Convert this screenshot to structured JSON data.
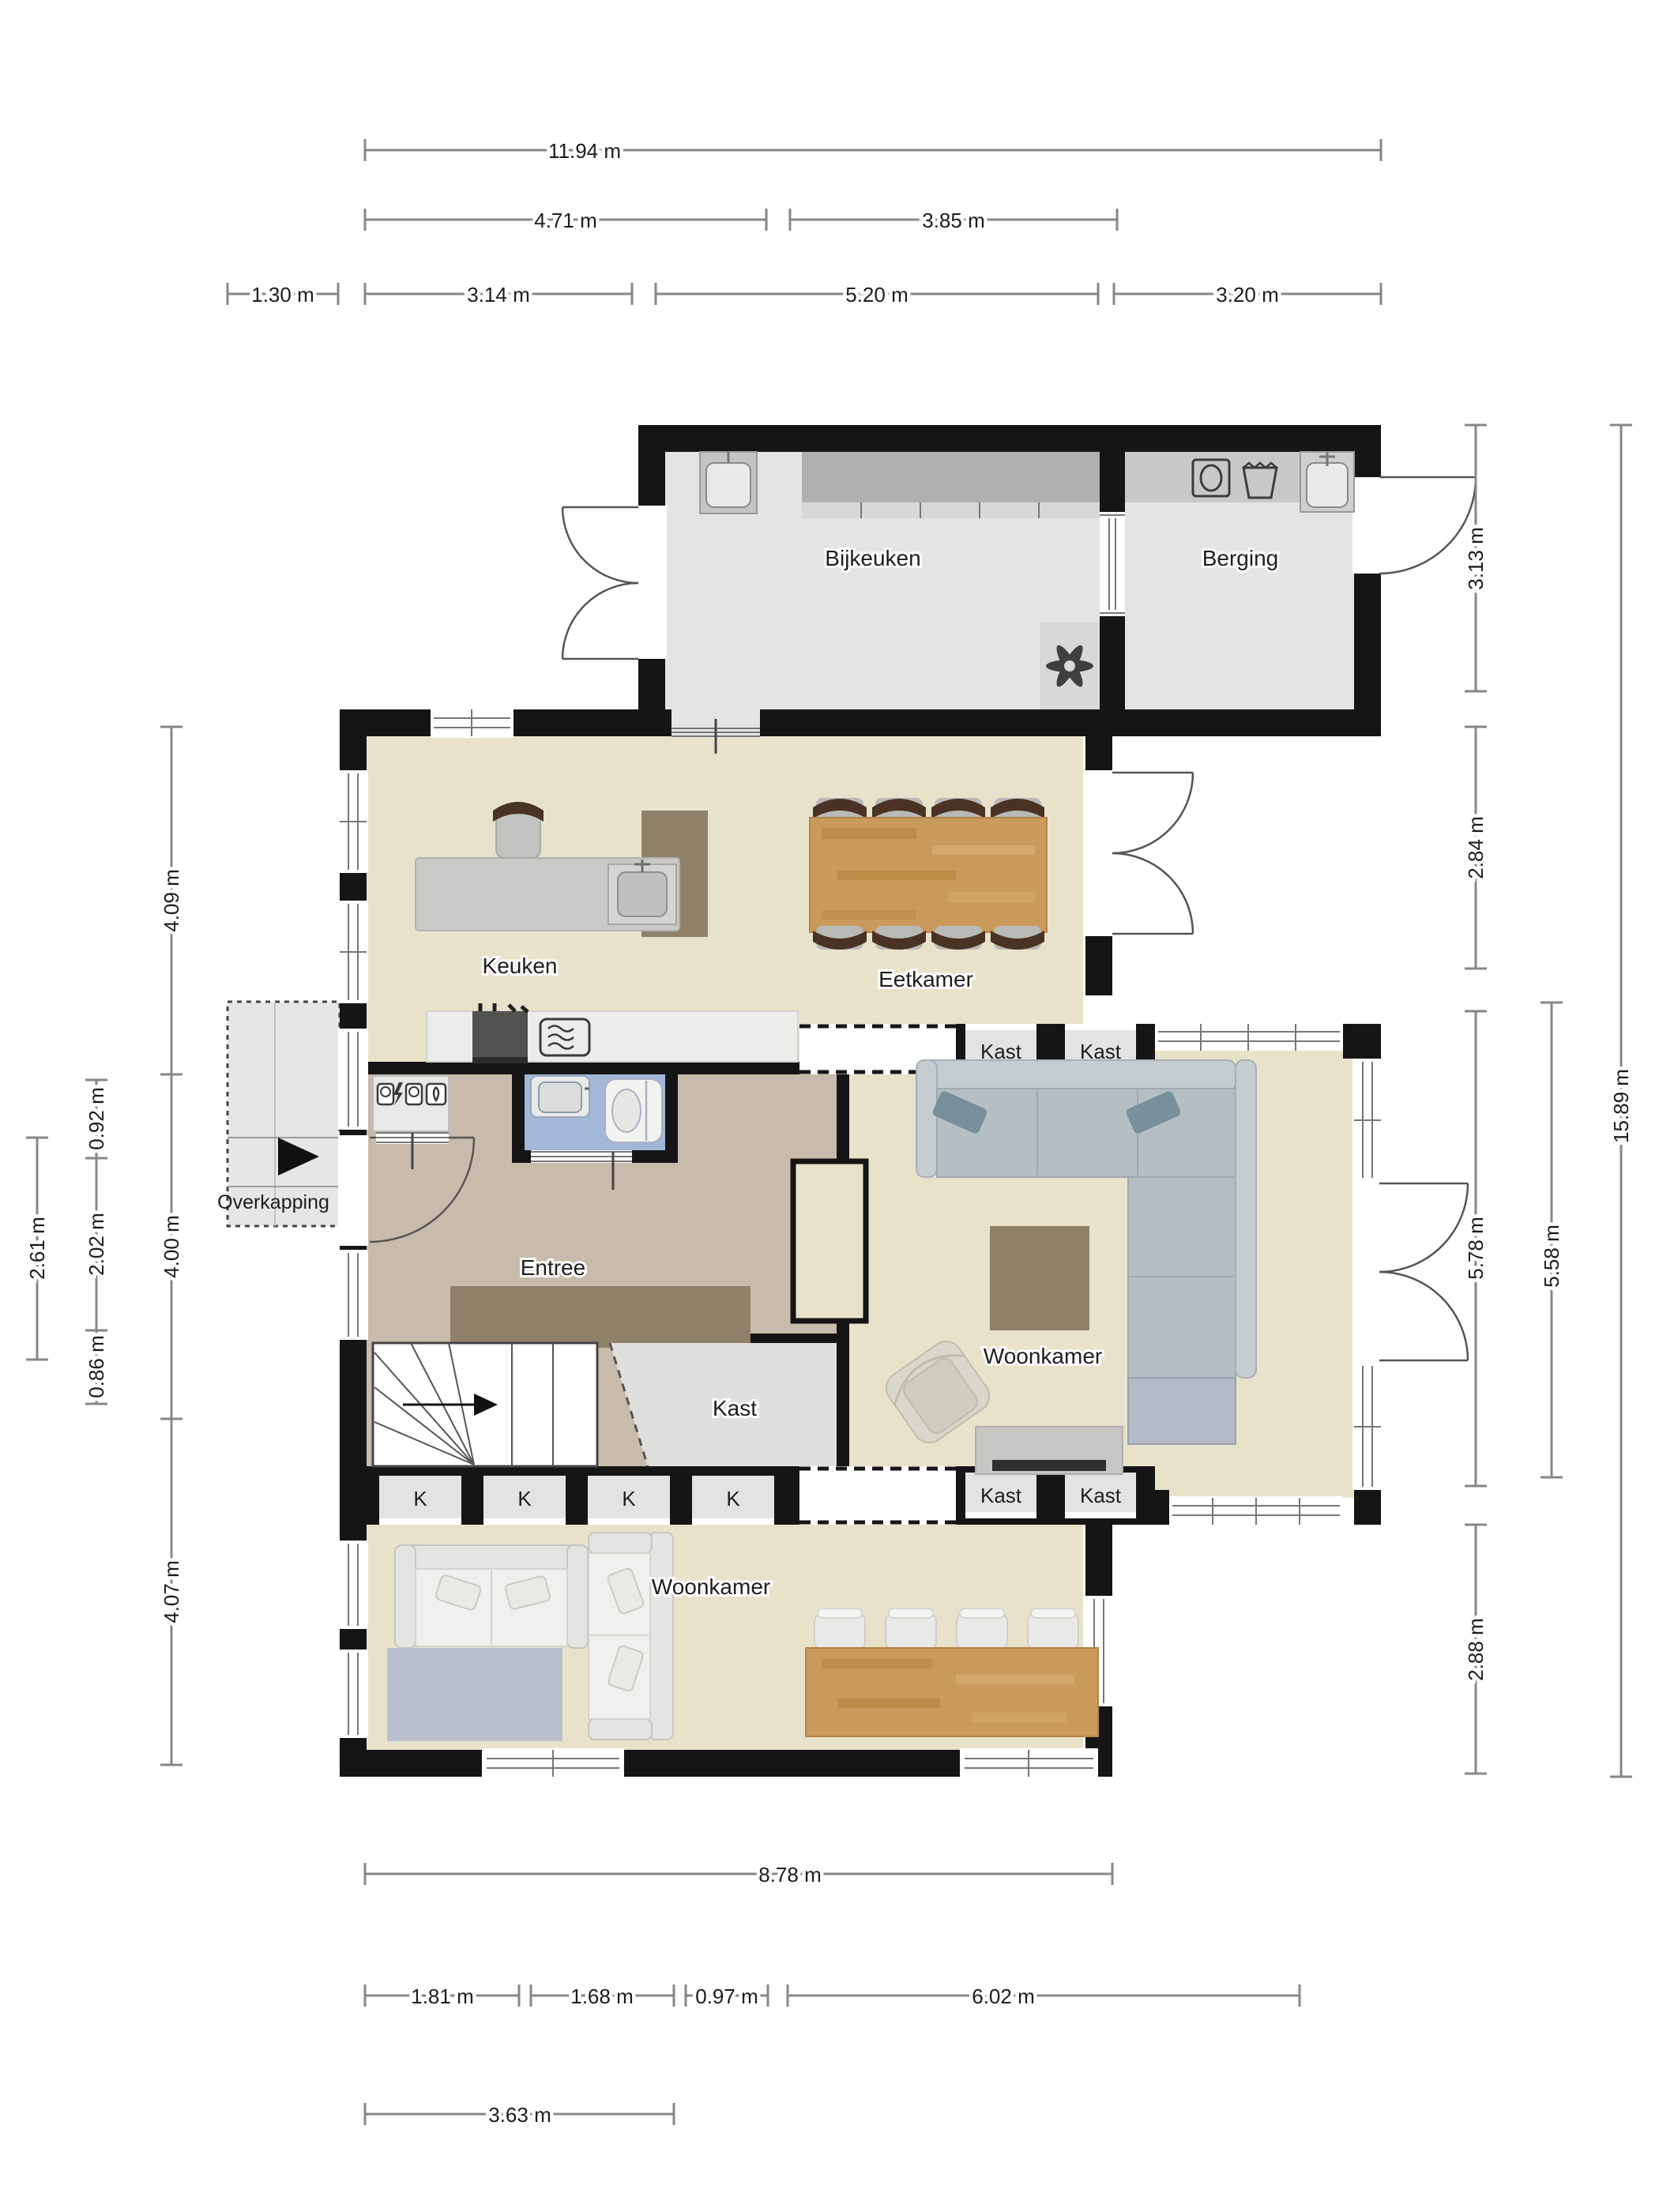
{
  "plan_type": "floorplan-ground-floor",
  "unit": "m",
  "rooms": {
    "bijkeuken": "Bijkeuken",
    "berging": "Berging",
    "keuken": "Keuken",
    "eetkamer": "Eetkamer",
    "entree": "Entree",
    "kast": "Kast",
    "woonkamer": "Woonkamer",
    "overkapping": "Overkapping",
    "locker": "K"
  },
  "dims": {
    "total_width": "11.94 m",
    "keuken_width": "4.71 m",
    "eetkamer_width": "3.85 m",
    "overkapping_width": "1.30 m",
    "entree_zone_width": "3.14 m",
    "bijkeuken_width": "5.20 m",
    "berging_width": "3.20 m",
    "main_width": "8.78 m",
    "seg_181": "1.81 m",
    "seg_168": "1.68 m",
    "seg_097": "0.97 m",
    "seg_602": "6.02 m",
    "seg_363": "3.63 m",
    "keuken_depth": "4.09 m",
    "entree_depth": "4.00 m",
    "woonkamer_depth": "4.07 m",
    "seg_092": "0.92 m",
    "seg_202": "2.02 m",
    "seg_086": "0.86 m",
    "overkapping_depth": "2.61 m",
    "berging_depth": "3.13 m",
    "eetkamer_depth": "2.84 m",
    "annex_depth": "5.78 m",
    "annex_glass_depth": "5.58 m",
    "annex_lower_depth": "2.88 m",
    "total_depth": "15.89 m"
  },
  "colors": {
    "wall": "#151515",
    "floor_living": "#e9e2cb",
    "floor_entree": "#c8bbab",
    "floor_toilet": "#a3b7d6",
    "floor_utility": "#e4e4e2",
    "counter_dark": "#b0b0ae",
    "wood": "#c99a5b",
    "sofa_gray": "#b5bec2",
    "dim_line": "#878787"
  }
}
